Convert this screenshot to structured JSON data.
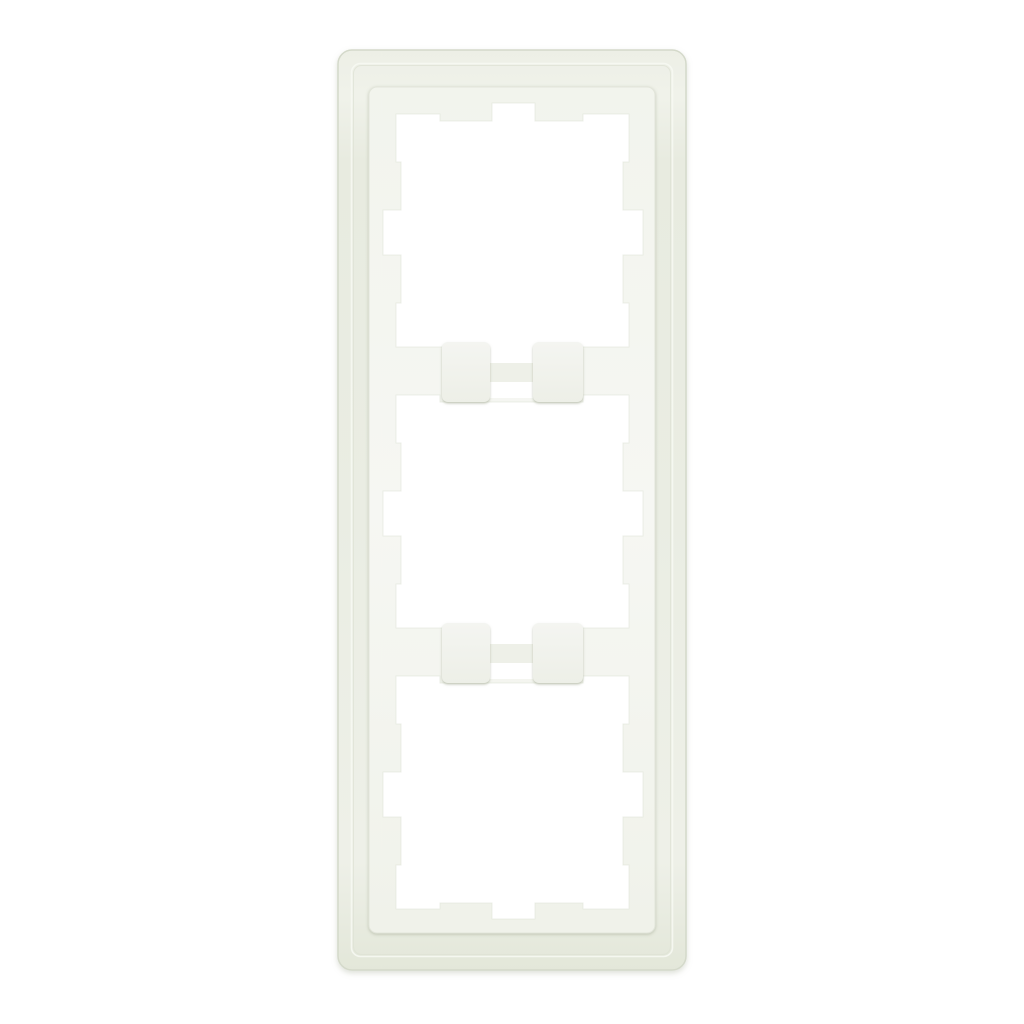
{
  "image": {
    "alt": "Product photo of a white triple cover frame with three square cutouts, shown upright on a plain white background"
  },
  "product": {
    "kind": "3-gang wall switch cover frame",
    "orientation": "vertical",
    "gangs": 3
  },
  "colors": {
    "background": "#ffffff",
    "glass_light": "#eff1e9",
    "glass_mid": "#e9ece1",
    "glass_dark": "#e1e5d7",
    "glass_edge": "#d4d9ca",
    "rim_shadow": "#dde1d4",
    "rim_highlight": "#f6f8f2",
    "insert_light": "#f7f8f4",
    "insert_mid": "#f3f5ef",
    "insert_dark": "#edefe6",
    "insert_edge": "#e2e5da",
    "tab_light": "#f4f5f1",
    "tab_dark": "#eef0e8",
    "opening": "#ffffff",
    "cutout_edge": "#dde1d6"
  }
}
